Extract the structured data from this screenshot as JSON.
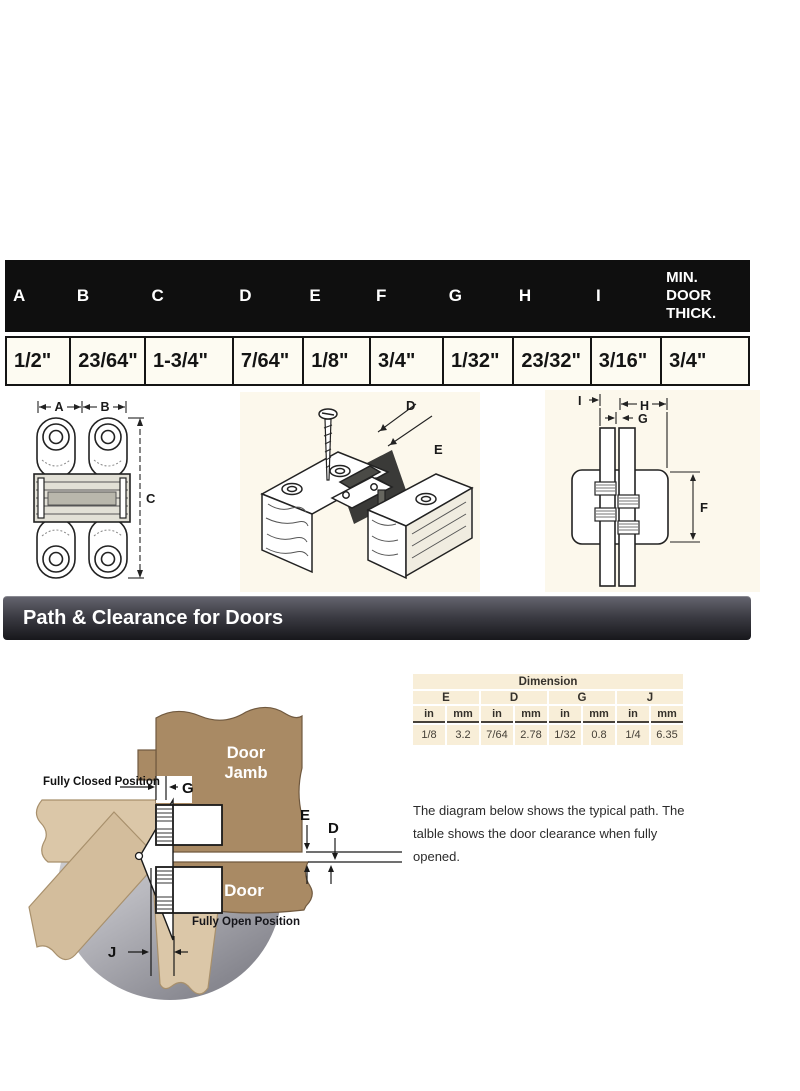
{
  "spec_table": {
    "headers": [
      "A",
      "B",
      "C",
      "D",
      "E",
      "F",
      "G",
      "H",
      "I",
      "MIN. DOOR THICK."
    ],
    "values": [
      "1/2\"",
      "23/64\"",
      "1-3/4\"",
      "7/64\"",
      "1/8\"",
      "3/4\"",
      "1/32\"",
      "23/32\"",
      "3/16\"",
      "3/4\""
    ]
  },
  "drawings": {
    "front_view": {
      "dim_a": "A",
      "dim_b": "B",
      "dim_c": "C"
    },
    "iso_view": {
      "dim_d": "D",
      "dim_e": "E"
    },
    "side_view": {
      "dim_i": "I",
      "dim_h": "H",
      "dim_g": "G",
      "dim_f": "F"
    }
  },
  "banner": {
    "title": "Path & Clearance for Doors"
  },
  "clearance": {
    "table": {
      "title": "Dimension",
      "units": {
        "in": "in",
        "mm": "mm"
      },
      "groups": [
        {
          "label": "E",
          "in": "1/8",
          "mm": "3.2"
        },
        {
          "label": "D",
          "in": "7/64",
          "mm": "2.78"
        },
        {
          "label": "G",
          "in": "1/32",
          "mm": "0.8"
        },
        {
          "label": "J",
          "in": "1/4",
          "mm": "6.35"
        }
      ]
    },
    "note": "The diagram below shows the typical path. The talble shows the door clearance when fully opened."
  },
  "path_diagram": {
    "fully_closed": "Fully Closed Position",
    "fully_open": "Fully Open Position",
    "jamb_line1": "Door",
    "jamb_line2": "Jamb",
    "door": "Door",
    "dim_g": "G",
    "dim_e": "E",
    "dim_d": "D",
    "dim_j": "J"
  },
  "colors": {
    "header_bg": "#0f0f0f",
    "banner_top": "#63636d",
    "banner_bottom": "#17171b",
    "panel_cream": "#fcf8ec",
    "table_cream": "#f8eed8",
    "wood": "#a98a64",
    "wood_light": "#dbc7a8"
  }
}
